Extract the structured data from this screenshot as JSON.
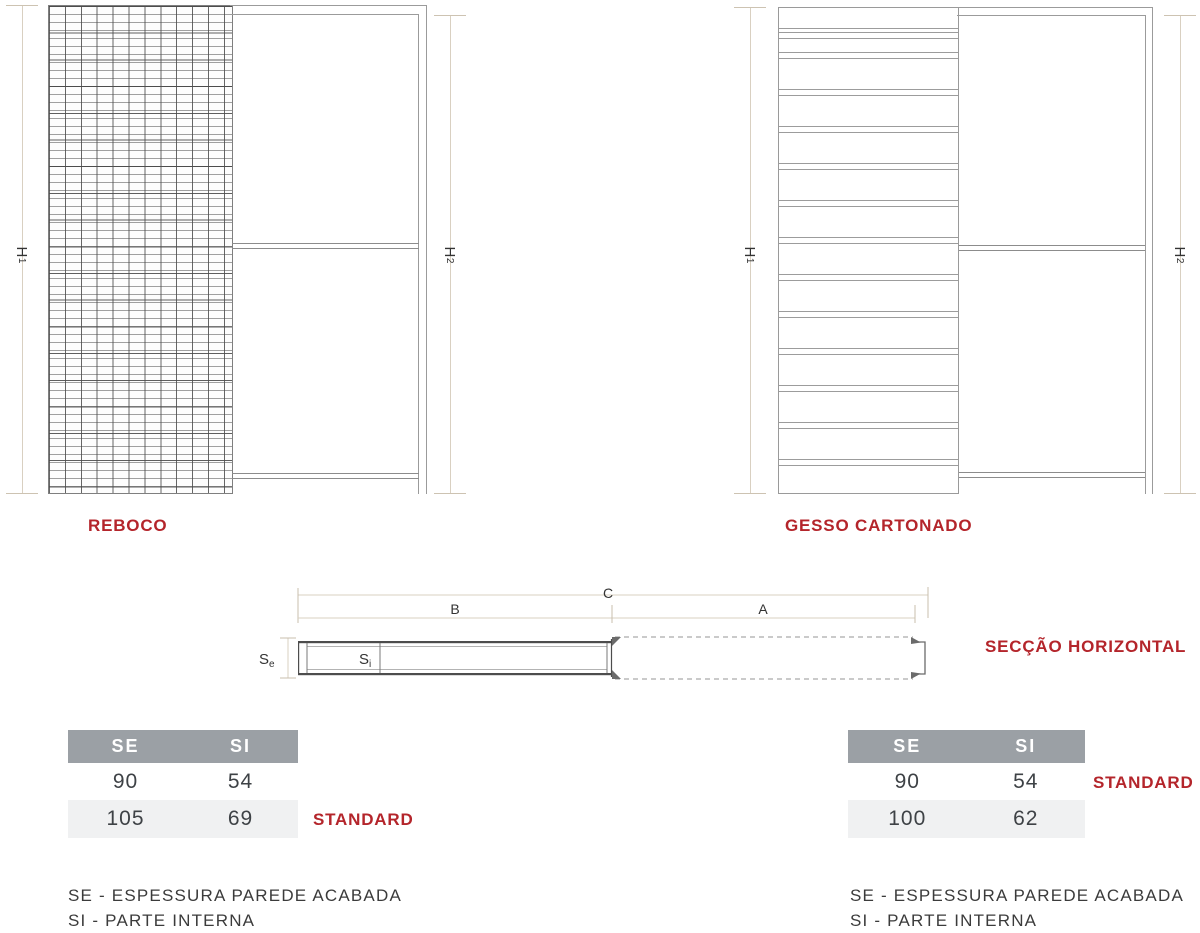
{
  "colors": {
    "accent_red": "#b4252b",
    "table_header_bg": "#9ba0a5",
    "table_alt_row_bg": "#f0f1f2",
    "dimension_line": "#d9d0c1",
    "drawing_line": "#8c8c8c"
  },
  "diagrams": {
    "reboco": {
      "title": "REBOCO",
      "dim_left": {
        "base": "H",
        "sub": "1"
      },
      "dim_right": {
        "base": "H",
        "sub": "2"
      }
    },
    "gesso": {
      "title": "GESSO CARTONADO",
      "dim_left": {
        "base": "H",
        "sub": "1"
      },
      "dim_right": {
        "base": "H",
        "sub": "2"
      }
    }
  },
  "section": {
    "title": "SECÇÃO HORIZONTAL",
    "dim_a": "A",
    "dim_b": "B",
    "dim_c": "C",
    "se": {
      "base": "S",
      "sub": "e"
    },
    "si": {
      "base": "S",
      "sub": "i"
    }
  },
  "tables": {
    "left": {
      "headers": [
        "SE",
        "SI"
      ],
      "rows": [
        {
          "se": "90",
          "si": "54",
          "tag": ""
        },
        {
          "se": "105",
          "si": "69",
          "tag": "STANDARD"
        }
      ]
    },
    "right": {
      "headers": [
        "SE",
        "SI"
      ],
      "rows": [
        {
          "se": "90",
          "si": "54",
          "tag": "STANDARD"
        },
        {
          "se": "100",
          "si": "62",
          "tag": ""
        }
      ]
    }
  },
  "legend": {
    "line1": "SE - ESPESSURA PAREDE ACABADA",
    "line2": "SI - PARTE INTERNA"
  }
}
